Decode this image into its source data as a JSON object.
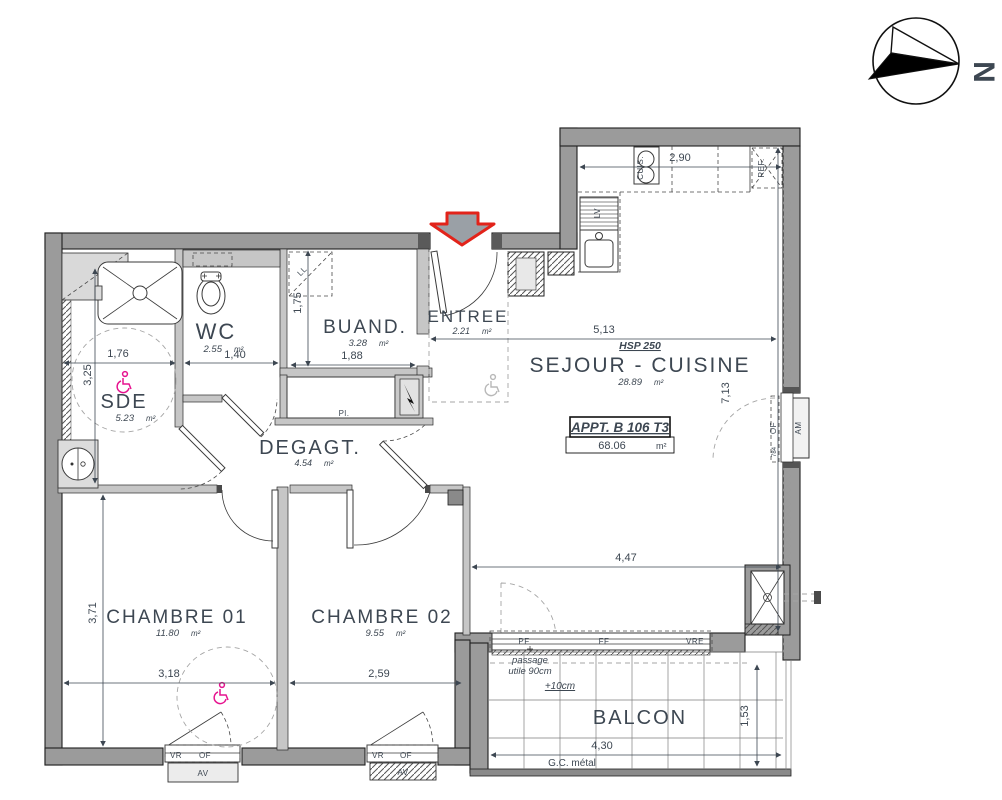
{
  "meta": {
    "unit": "m²",
    "north": "N"
  },
  "apartment": {
    "label": "APPT. B 106 T3",
    "area": "68.06"
  },
  "rooms": {
    "sde": {
      "name": "SDE",
      "area": "5.23"
    },
    "wc": {
      "name": "WC",
      "area": "2.55"
    },
    "buand": {
      "name": "BUAND.",
      "area": "3.28"
    },
    "entree": {
      "name": "ENTREE",
      "area": "2.21"
    },
    "sejour": {
      "name": "SEJOUR - CUISINE",
      "area": "28.89",
      "hsp": "HSP 250"
    },
    "degagt": {
      "name": "DEGAGT.",
      "area": "4.54"
    },
    "ch1": {
      "name": "CHAMBRE 01",
      "area": "11.80"
    },
    "ch2": {
      "name": "CHAMBRE 02",
      "area": "9.55"
    },
    "balcon": {
      "name": "BALCON"
    }
  },
  "dims": {
    "sde_w": "1,76",
    "sde_h": "3,25",
    "wc_w": "1,40",
    "buand_h": "1,75",
    "buand_w": "1,88",
    "kitchen_w": "2,90",
    "sejour_w": "5,13",
    "sejour_h": "7,13",
    "sejour_s": "4,47",
    "ch_h": "3,71",
    "ch1_w": "3,18",
    "ch2_w": "2,59",
    "balcon_w": "4,30",
    "balcon_h": "1,53",
    "window_e": "784"
  },
  "labels": {
    "lv": "LV",
    "ll": "LL",
    "cuis": "CUIS.",
    "ref": "REF.",
    "pl": "Pl.",
    "of": "OF",
    "av": "AV",
    "am": "AM",
    "vr": "VR",
    "pf": "PF",
    "ff": "FF",
    "vre": "VRE",
    "passage1": "passage",
    "passage2": "utile 90cm",
    "plus10": "+10cm",
    "gc": "G.C.  métal"
  }
}
